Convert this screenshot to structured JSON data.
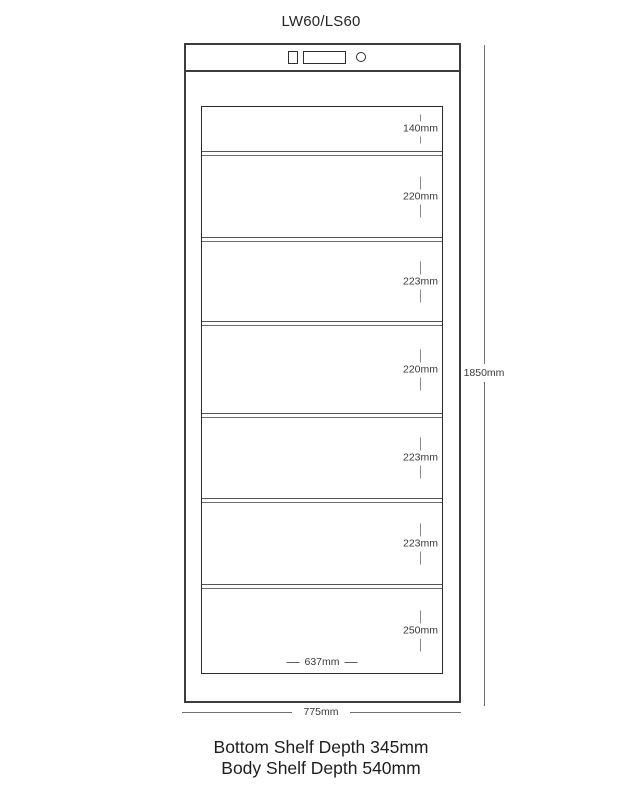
{
  "title": "LW60/LS60",
  "cabinet": {
    "shelves": [
      {
        "label": "140mm"
      },
      {
        "label": "220mm"
      },
      {
        "label": "223mm"
      },
      {
        "label": "220mm"
      },
      {
        "label": "223mm"
      },
      {
        "label": "223mm"
      },
      {
        "label": "250mm"
      }
    ],
    "inner_width_label": "637mm",
    "overall_width_label": "775mm",
    "overall_height_label": "1850mm"
  },
  "footer": {
    "line1": "Bottom Shelf Depth 345mm",
    "line2": "Body Shelf Depth 540mm"
  },
  "colors": {
    "outline": "#3d3d3d",
    "divider": "#565656",
    "dimension_line": "#707070",
    "text": "#1e1e1e"
  }
}
